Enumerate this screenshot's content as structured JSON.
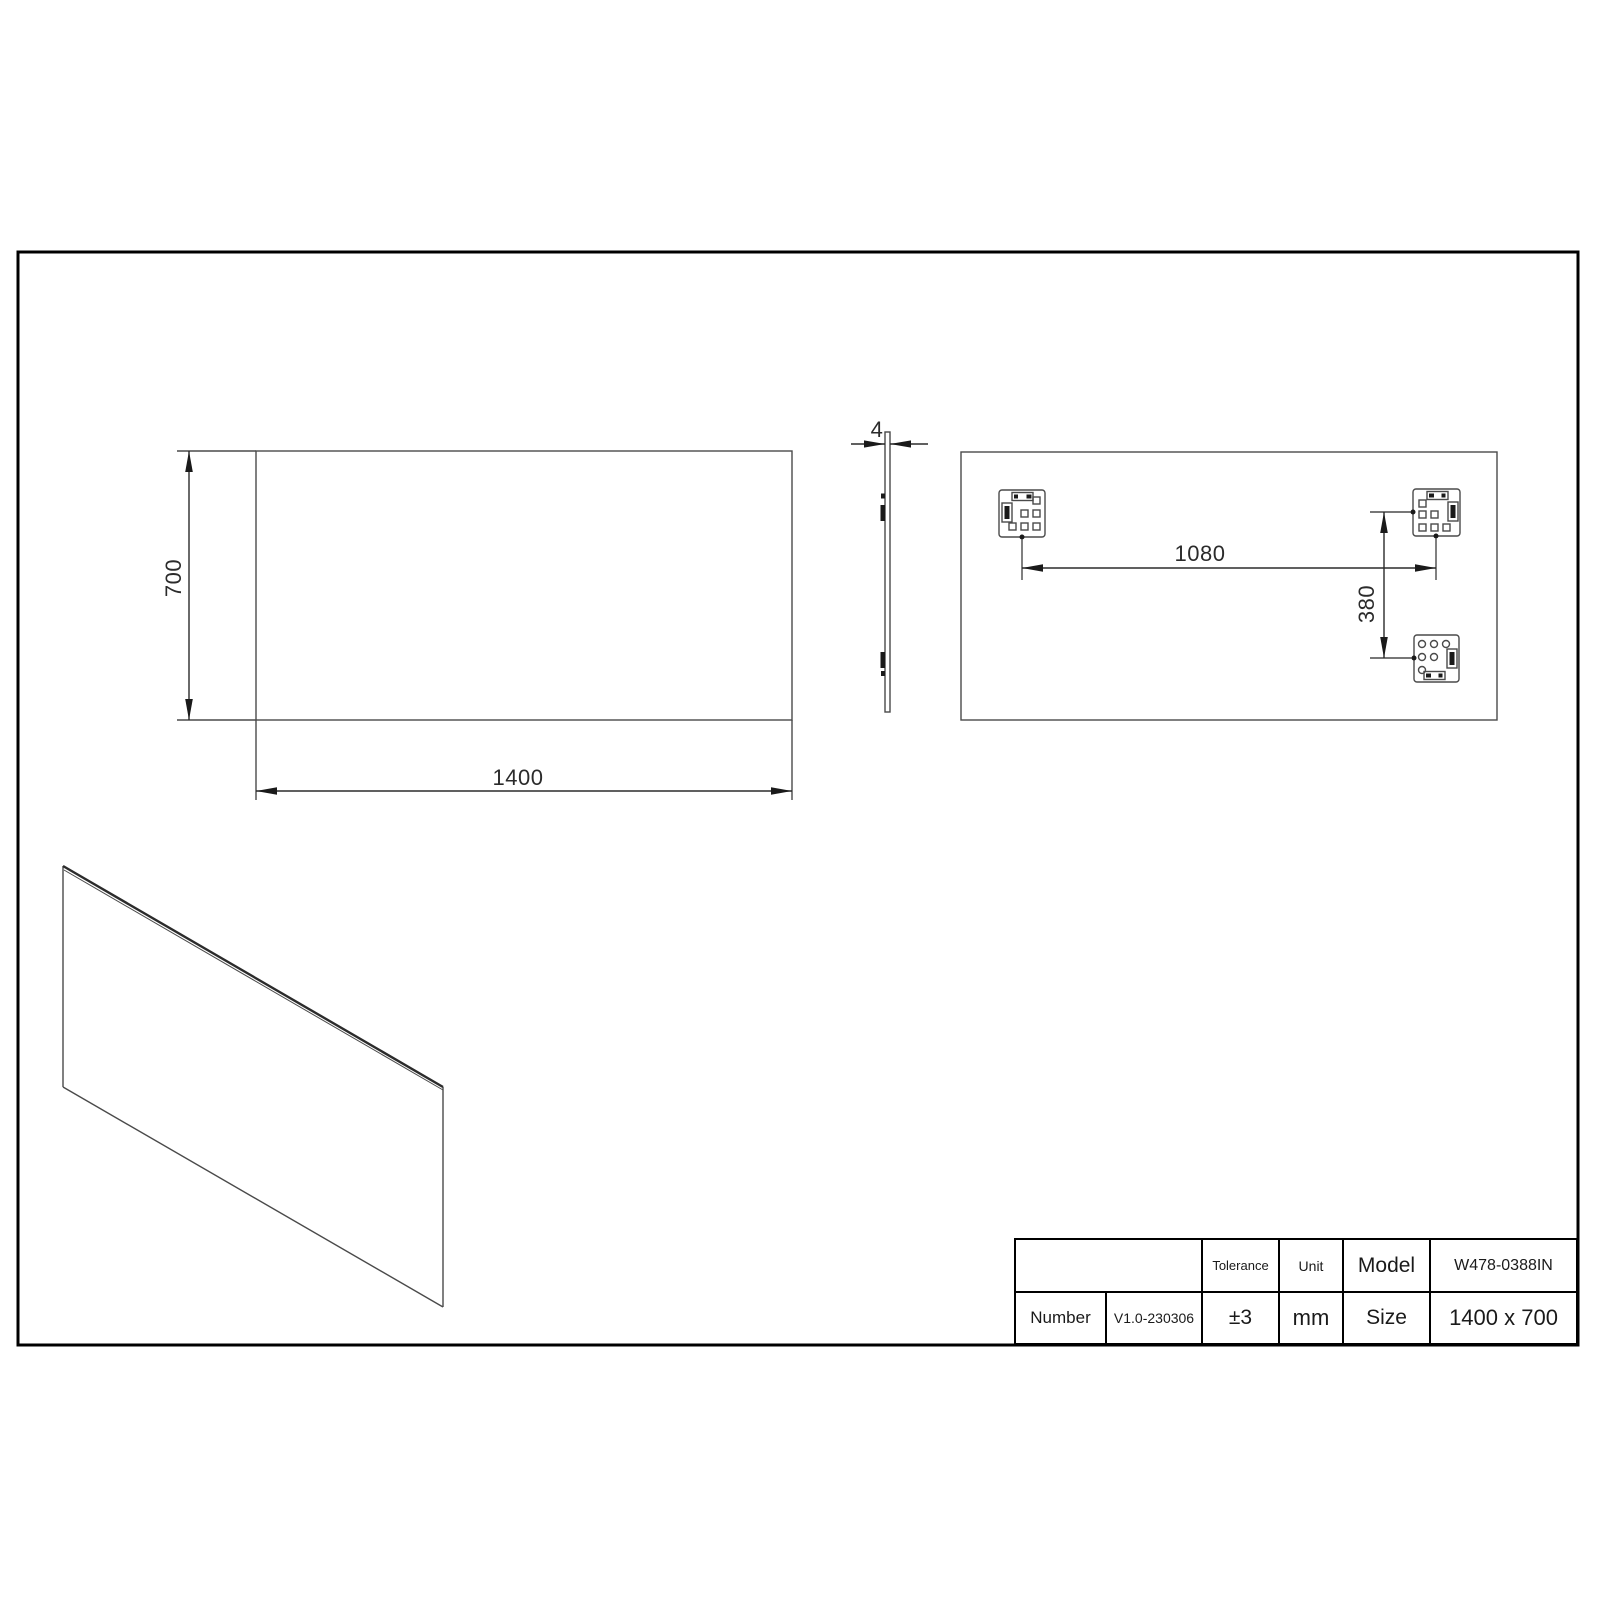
{
  "drawing": {
    "dimensions": {
      "front_width": "1400",
      "front_height": "700",
      "thickness": "4",
      "bracket_spacing_horizontal": "1080",
      "bracket_spacing_vertical": "380"
    },
    "title_block": {
      "number_label": "Number",
      "number_value": "V1.0-230306",
      "tolerance_label": "Tolerance",
      "tolerance_value": "±3",
      "unit_label": "Unit",
      "unit_value": "mm",
      "model_label": "Model",
      "model_value": "W478-0388IN",
      "size_label": "Size",
      "size_value": "1400 x 700"
    },
    "colors": {
      "line": "#4a4a4a",
      "dark": "#1a1a1a",
      "border": "#000000",
      "background": "#ffffff"
    }
  }
}
